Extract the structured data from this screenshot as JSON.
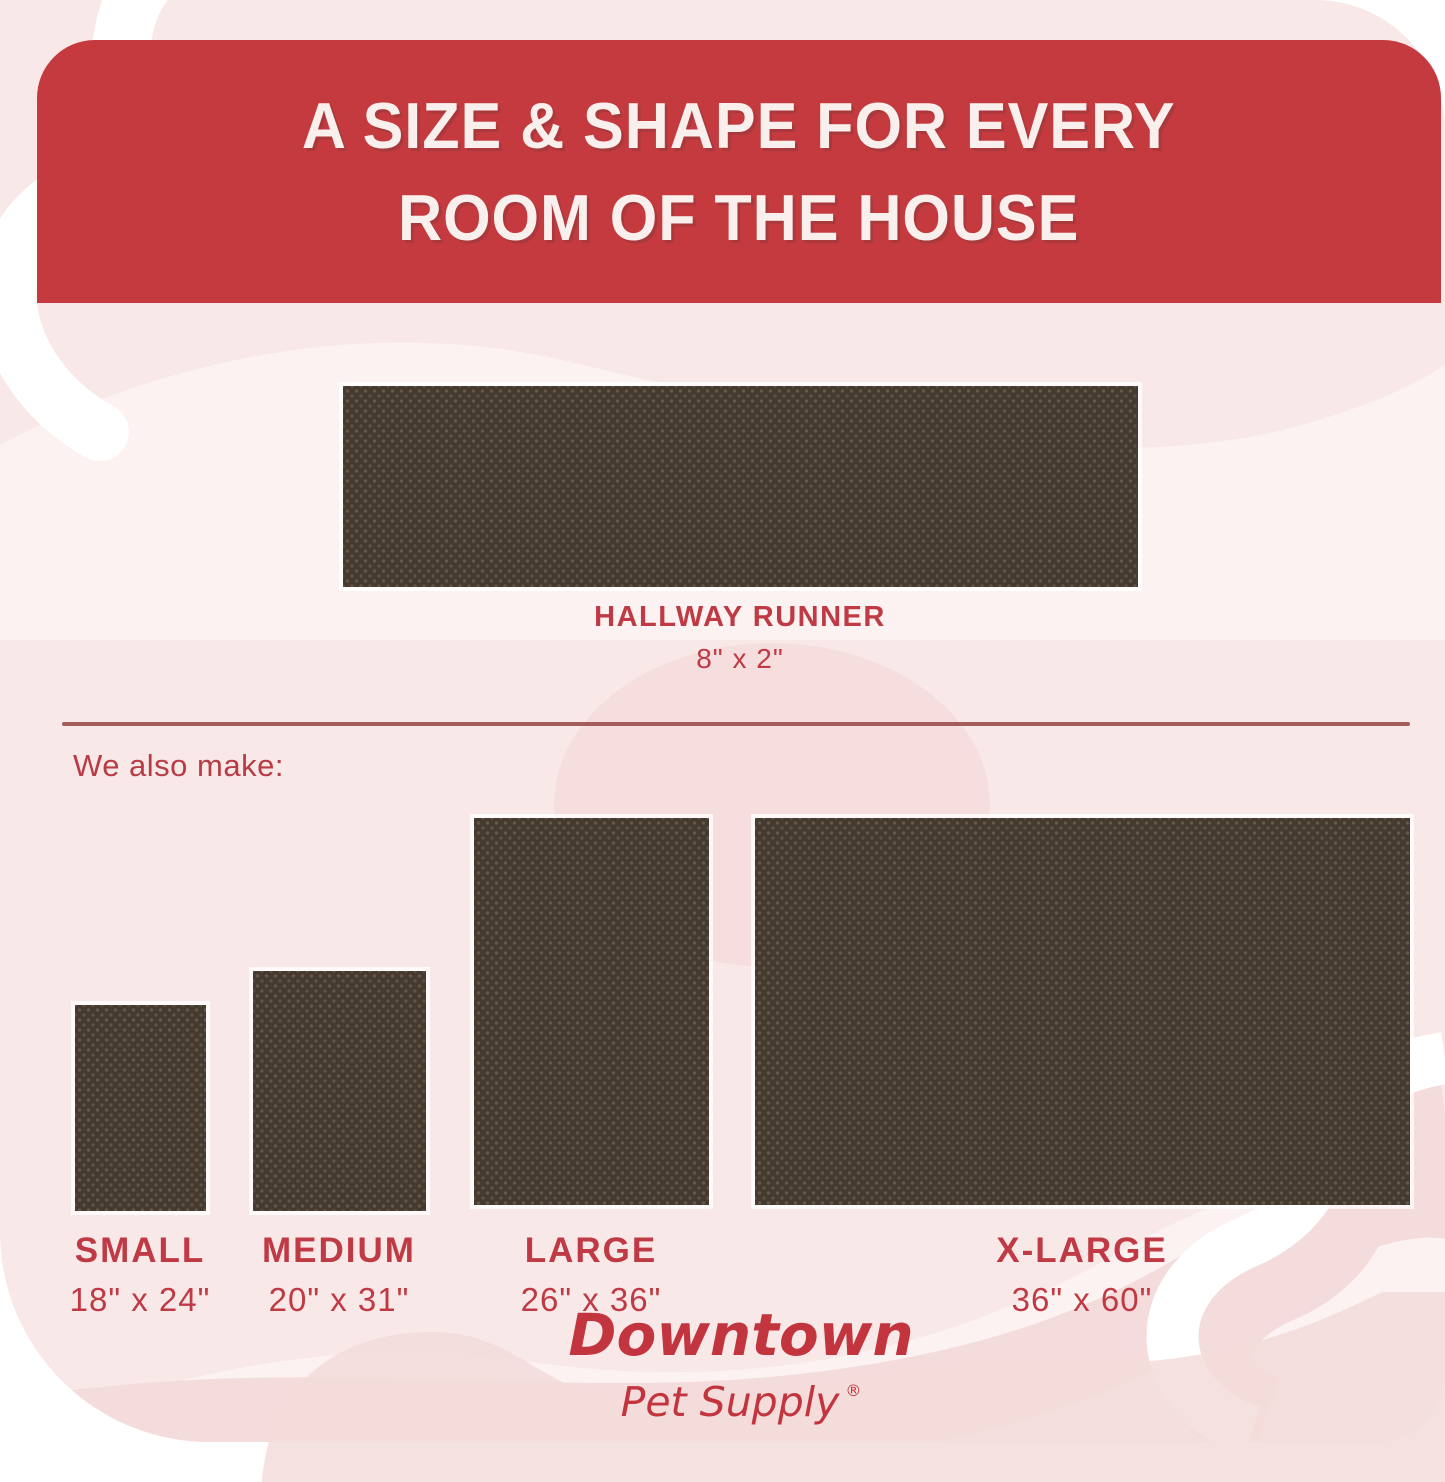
{
  "header": {
    "title_line1": "A SIZE & SHAPE FOR EVERY",
    "title_line2": "ROOM OF THE HOUSE"
  },
  "hallway": {
    "name": "HALLWAY RUNNER",
    "size": "8\" x 2\""
  },
  "note_also_make": "We also make:",
  "products": [
    {
      "name": "SMALL",
      "size": "18\" x 24\""
    },
    {
      "name": "MEDIUM",
      "size": "20\" x 31\""
    },
    {
      "name": "LARGE",
      "size": "26\" x 36\""
    },
    {
      "name": "X-LARGE",
      "size": "36\" x 60\""
    }
  ],
  "brand": {
    "line1": "Downtown",
    "line2": "Pet Supply",
    "registered": "®"
  },
  "colors": {
    "banner_red": "#c43a3e",
    "label_red": "#bf3a44",
    "divider_red": "#a25d5c",
    "mat_brown": "#453a2f",
    "background_pink": "#f8e9e8",
    "decor_pink": "#f3dcdb",
    "decor_light": "#fbf2f1"
  }
}
